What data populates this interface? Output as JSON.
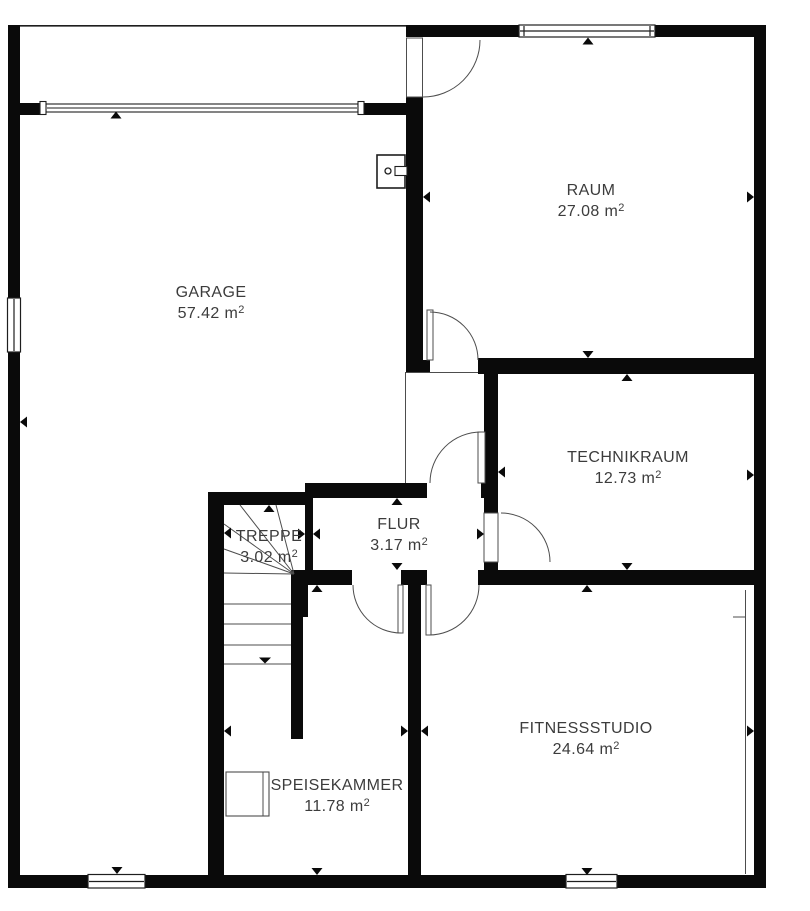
{
  "plan": {
    "unit_suffix": "m",
    "superscript": "2"
  },
  "rooms": [
    {
      "id": "garage",
      "label": "GARAGE",
      "area": "57.42 m",
      "area_m2": 57.42
    },
    {
      "id": "raum",
      "label": "RAUM",
      "area": "27.08 m",
      "area_m2": 27.08
    },
    {
      "id": "technikraum",
      "label": "TECHNIKRAUM",
      "area": "12.73 m",
      "area_m2": 12.73
    },
    {
      "id": "flur",
      "label": "FLUR",
      "area": "3.17 m",
      "area_m2": 3.17
    },
    {
      "id": "treppe",
      "label": "TREPPE",
      "area": "3.02 m",
      "area_m2": 3.02
    },
    {
      "id": "speisekammer",
      "label": "SPEISEKAMMER",
      "area": "11.78 m",
      "area_m2": 11.78
    },
    {
      "id": "fitnessstudio",
      "label": "FITNESSSTUDIO",
      "area": "24.64 m",
      "area_m2": 24.64
    }
  ],
  "colors": {
    "background": "#ffffff",
    "wall": "#0a0a0a",
    "line": "#4d4d4d",
    "frame": "#1e1e1e",
    "text": "#3c3c3c"
  }
}
